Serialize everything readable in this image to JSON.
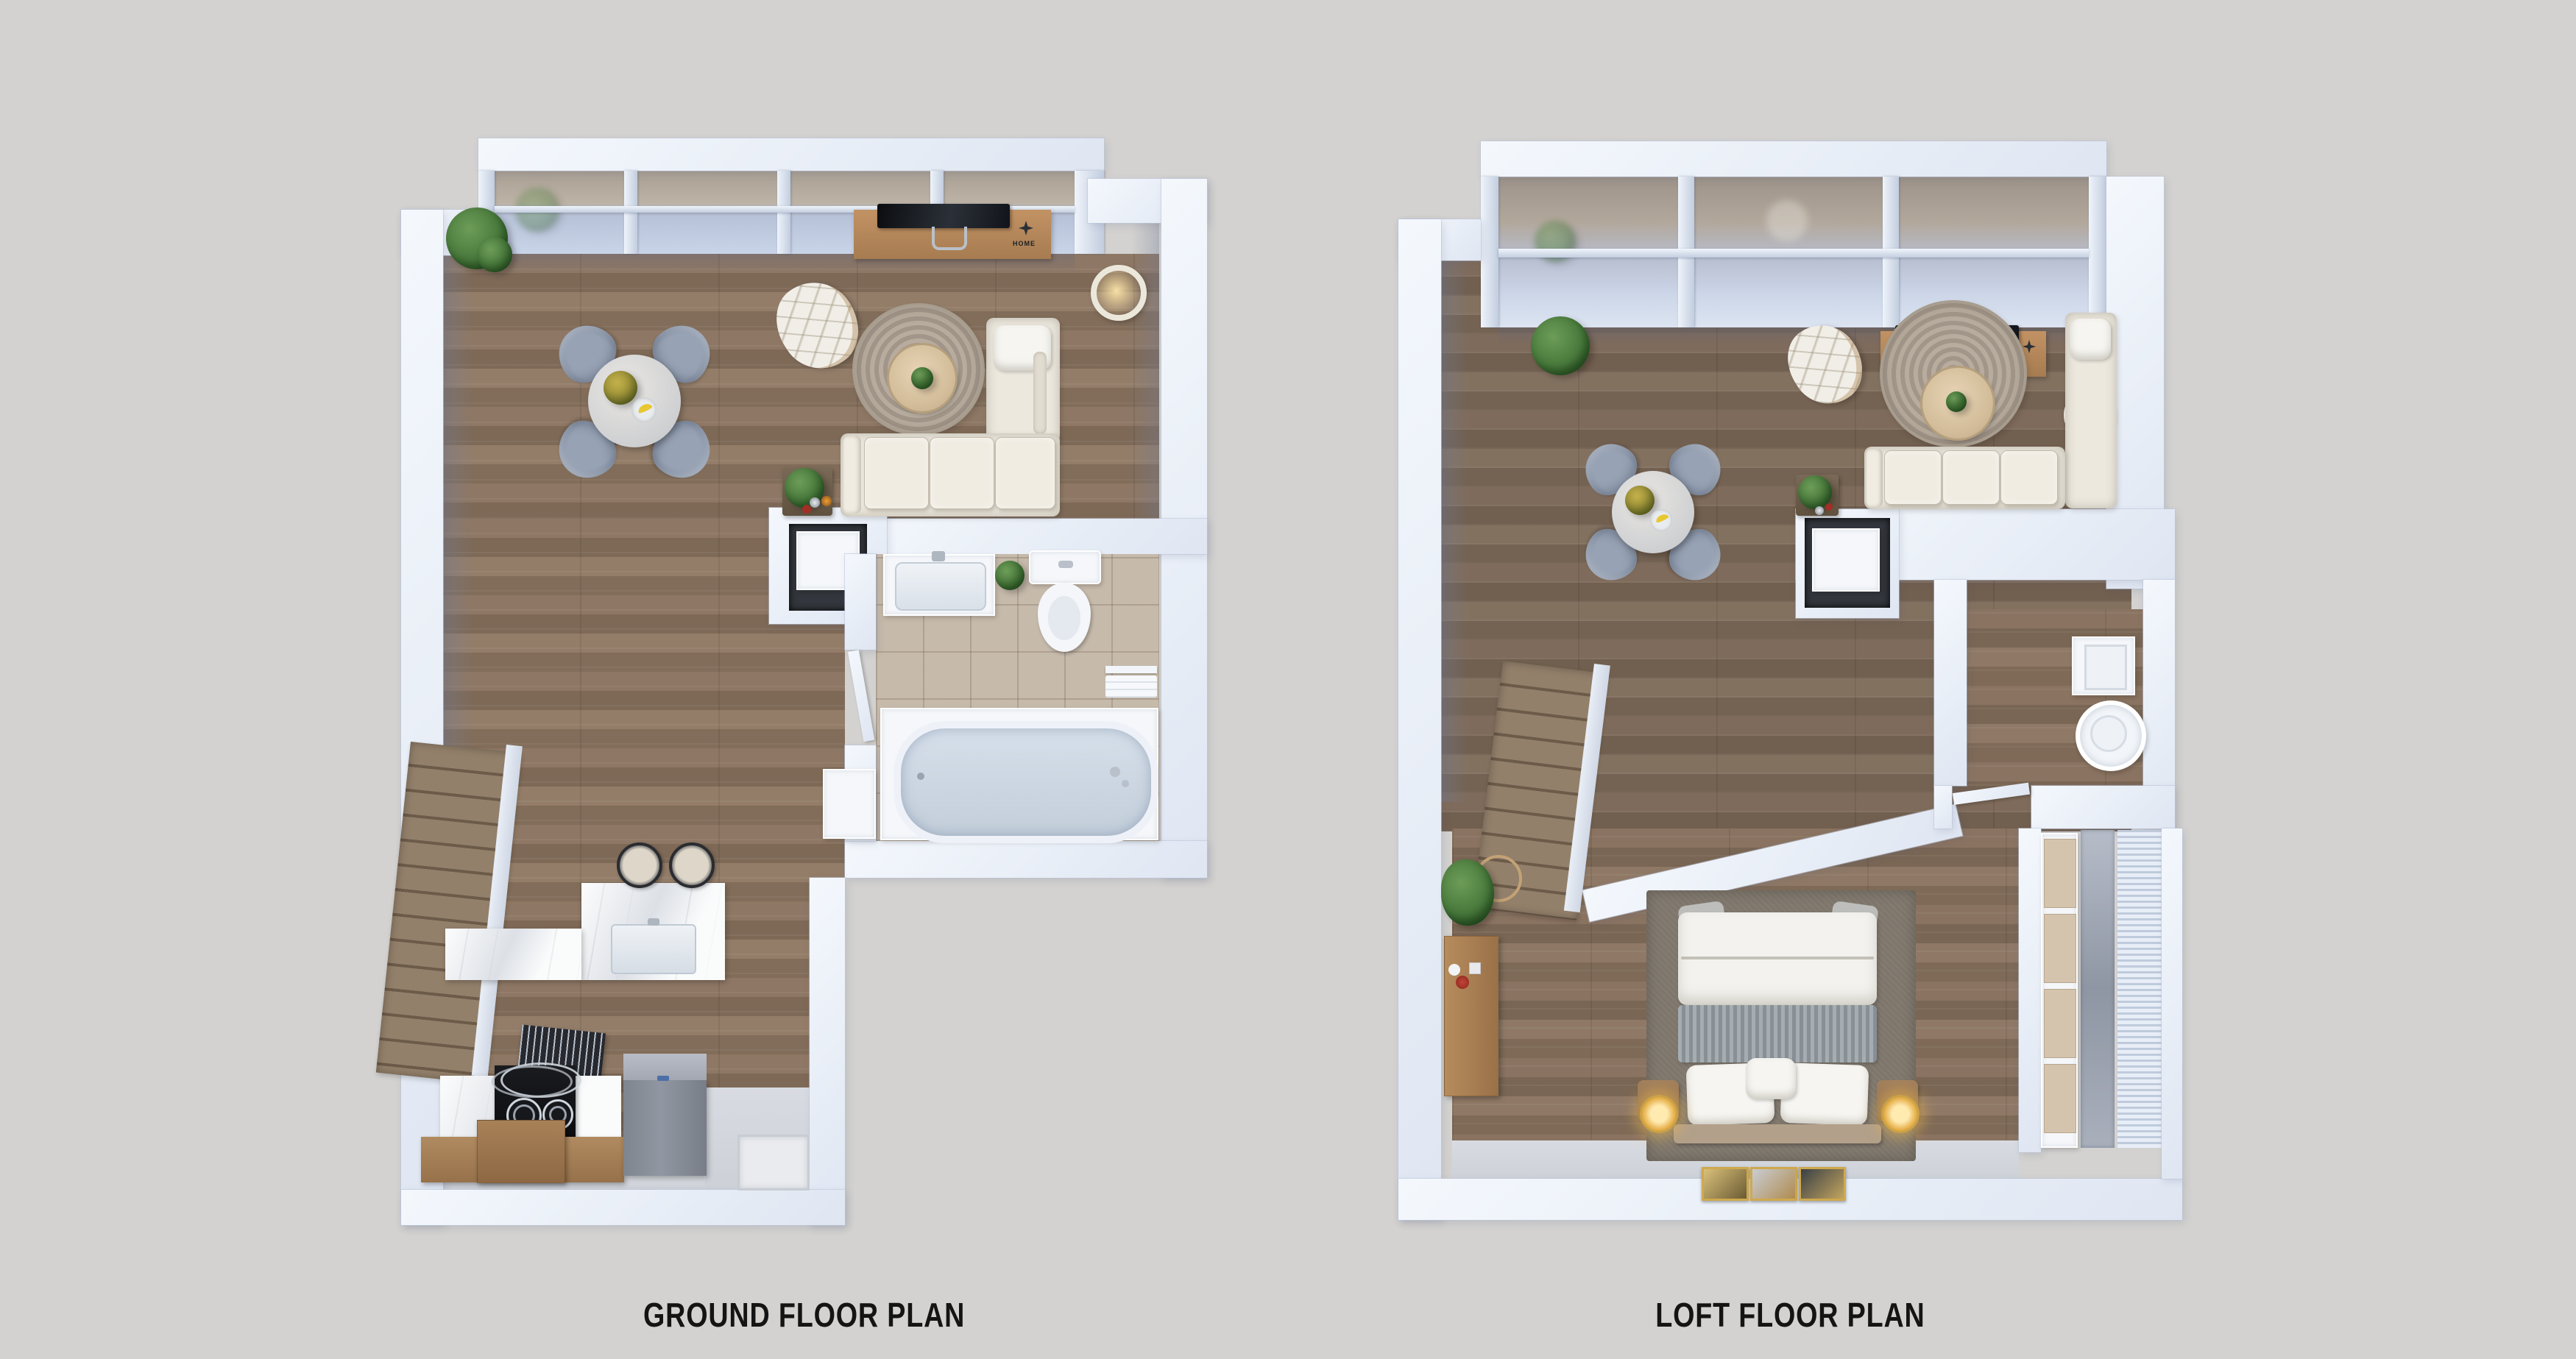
{
  "background_color": "#d3d2d0",
  "ground_plan": {
    "title": "GROUND FLOOR PLAN",
    "console_sign": "HOME",
    "rooms": [
      "living-dining area",
      "kitchen",
      "bathroom",
      "entry",
      "staircase"
    ],
    "furniture": [
      "window wall",
      "potted plant",
      "round dining table with four chairs",
      "table plant",
      "fruit bowl with bananas",
      "quilted lounge chair",
      "tv console",
      "television",
      "floor ring lamp",
      "round jute rug",
      "round coffee table",
      "l-shaped cream sofa",
      "side table with plant",
      "fireplace niche",
      "bathroom sink",
      "toilet",
      "bathtub",
      "towel rail",
      "bathroom door",
      "kitchen island with sink",
      "two bar stools",
      "cooktop with chrome rails",
      "refrigerator",
      "kitchen cabinets",
      "staircase",
      "under-stair rack",
      "entry mat"
    ]
  },
  "loft_plan": {
    "title": "LOFT FLOOR PLAN",
    "rooms": [
      "open void over living room",
      "bedroom",
      "utility room",
      "wardrobe closet",
      "staircase"
    ],
    "furniture": [
      "skylight glazing",
      "dining set seen below",
      "lounge chair seen below",
      "tv console seen below",
      "round rug seen below",
      "sofa seen below",
      "floor ring lamp",
      "fireplace niche",
      "guard wall",
      "staircase",
      "double bed",
      "bed rug",
      "striped blanket",
      "pillows",
      "two nightstands",
      "two gold lamps",
      "three framed artworks",
      "bedside cabinet",
      "potted plant",
      "washing machine",
      "water boiler",
      "wardrobe drawers",
      "glass panel",
      "slatted panel"
    ]
  },
  "colors": {
    "wall": "#edf2fa",
    "wood_floor": "#87705d",
    "tile_floor": "#c6baab",
    "marble": "#eceef1",
    "sofa_cream": "#ece8de",
    "chair_gray": "#8d98aa",
    "rug": "#aca092",
    "accent_gold": "#e2a83e",
    "glass": "#b8c3d8",
    "label_text": "#141414"
  }
}
